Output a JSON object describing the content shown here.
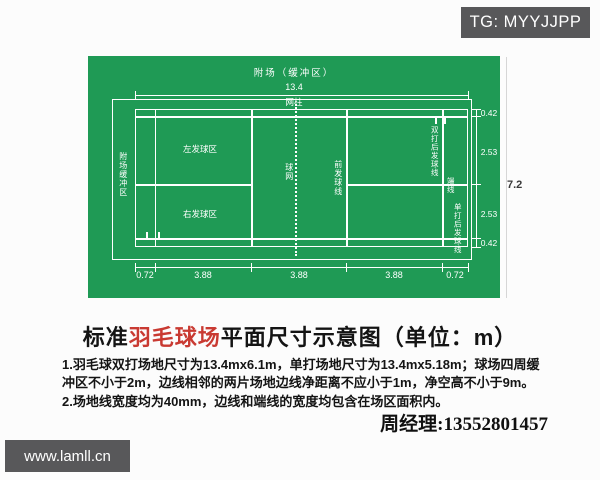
{
  "watermarks": {
    "tg": "TG: MYYJJPP",
    "site": "www.lamll.cn"
  },
  "diagram": {
    "colors": {
      "court_green": "#1f9a55",
      "line_white": "#ffffff",
      "badge_gray": "#58585a",
      "title_red": "#c93a32"
    },
    "labels": {
      "buffer_top": "附场（缓冲区）",
      "buffer_left": "附场缓冲区",
      "net_post": "网柱",
      "net": "球网",
      "left_service": "左发球区",
      "right_service": "右发球区",
      "front_service_line": "前发球线",
      "doubles_back_service_line": "双打后发球线",
      "end_line": "端线",
      "singles_back_service_line": "单打后发球线"
    },
    "dimensions": {
      "total_length": "13.4",
      "total_height": "7.2",
      "bottom_segments": [
        "0.72",
        "3.88",
        "3.88",
        "3.88",
        "0.72"
      ],
      "right_segments": [
        "0.42",
        "2.53",
        "2.53",
        "0.42"
      ]
    }
  },
  "title": {
    "prefix": "标准",
    "highlight": "羽毛球场",
    "suffix": "平面尺寸示意图（单位：m）"
  },
  "notes": [
    "1.羽毛球双打场地尺寸为13.4mx6.1m，单打场地尺寸为13.4mx5.18m；球场四周缓冲区不小于2m，边线相邻的两片场地边线净距离不应小于1m，净空高不小于9m。",
    "2.场地线宽度均为40mm，边线和端线的宽度均包含在场区面积内。"
  ],
  "contact": "周经理:13552801457"
}
